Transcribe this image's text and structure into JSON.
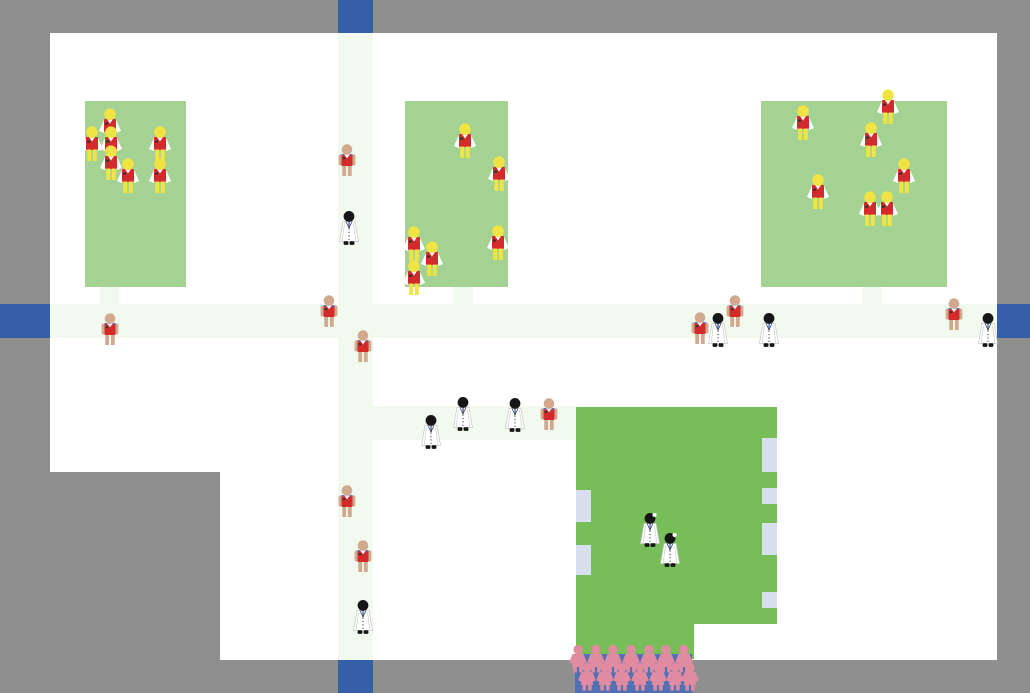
{
  "app": {
    "title": "village-simulation-map"
  },
  "colors": {
    "surround": "#8f8f8f",
    "map_ground": "#ffffff",
    "road": "#f2faf0",
    "field_green": "#a3d292",
    "building_green": "#77be59",
    "window_lavender": "#d8dfee",
    "exit_blue": "#3560a8",
    "farmer_skin": "#f0e344",
    "villager_skin": "#d0a98e",
    "vest_red": "#d32b2b",
    "sleeve_white": "#ffffff",
    "doctor_black": "#161616",
    "coat_white": "#ffffff",
    "coat_outline": "#c6c6c6",
    "tie_blue": "#4a79d6",
    "badge_dark": "#333333",
    "crowd_pink": "#e18ba0",
    "crowd_blue": "#5271b5"
  },
  "map": {
    "areas": [
      {
        "name": "map-area-main",
        "x": 220,
        "y": 33,
        "w": 777,
        "h": 627
      },
      {
        "name": "map-area-left",
        "x": 50,
        "y": 33,
        "w": 170,
        "h": 439
      }
    ],
    "roads": [
      {
        "name": "road-vertical",
        "x": 338,
        "y": 33,
        "w": 35,
        "h": 627
      },
      {
        "name": "road-horizontal",
        "x": 50,
        "y": 304,
        "w": 947,
        "h": 34
      },
      {
        "name": "road-building-path",
        "x": 373,
        "y": 406,
        "w": 203,
        "h": 34
      },
      {
        "name": "road-stub-field-1",
        "x": 100,
        "y": 287,
        "w": 19,
        "h": 17
      },
      {
        "name": "road-stub-field-2",
        "x": 453,
        "y": 287,
        "w": 20,
        "h": 17
      },
      {
        "name": "road-stub-field-3",
        "x": 862,
        "y": 287,
        "w": 20,
        "h": 17
      }
    ],
    "exits": [
      {
        "name": "map-exit-top",
        "x": 338,
        "y": 0,
        "w": 35,
        "h": 33
      },
      {
        "name": "map-exit-left",
        "x": 0,
        "y": 304,
        "w": 50,
        "h": 34
      },
      {
        "name": "map-exit-right",
        "x": 997,
        "y": 304,
        "w": 33,
        "h": 34
      },
      {
        "name": "map-exit-bottom",
        "x": 338,
        "y": 660,
        "w": 35,
        "h": 33
      }
    ],
    "fields": [
      {
        "name": "field-1",
        "x": 85,
        "y": 101,
        "w": 101,
        "h": 186
      },
      {
        "name": "field-2",
        "x": 405,
        "y": 101,
        "w": 103,
        "h": 186
      },
      {
        "name": "field-3",
        "x": 761,
        "y": 101,
        "w": 186,
        "h": 186
      }
    ],
    "building": {
      "name": "clinic-building",
      "parts": [
        {
          "x": 576,
          "y": 407,
          "w": 201,
          "h": 217
        },
        {
          "x": 576,
          "y": 624,
          "w": 118,
          "h": 35
        }
      ],
      "windows": [
        {
          "x": 576,
          "y": 490,
          "w": 15,
          "h": 32
        },
        {
          "x": 576,
          "y": 545,
          "w": 15,
          "h": 30
        },
        {
          "x": 762,
          "y": 438,
          "w": 15,
          "h": 34
        },
        {
          "x": 762,
          "y": 488,
          "w": 15,
          "h": 16
        },
        {
          "x": 762,
          "y": 523,
          "w": 15,
          "h": 32
        },
        {
          "x": 762,
          "y": 592,
          "w": 15,
          "h": 16
        }
      ]
    },
    "crowd": {
      "name": "visitor-queue",
      "bg": {
        "x": 575,
        "y": 654,
        "w": 117,
        "h": 39
      },
      "figure_w": 22,
      "figure_h": 30,
      "rows": [
        {
          "y": 645,
          "xs": [
            578,
            596,
            613,
            631,
            649,
            666,
            684
          ]
        },
        {
          "y": 663,
          "xs": [
            587,
            605,
            622,
            640,
            658,
            675,
            690
          ]
        }
      ]
    },
    "characters": [
      {
        "type": "farmer",
        "x": 110,
        "y": 108
      },
      {
        "type": "farmer",
        "x": 92,
        "y": 126
      },
      {
        "type": "farmer",
        "x": 111,
        "y": 126
      },
      {
        "type": "farmer",
        "x": 160,
        "y": 126
      },
      {
        "type": "farmer",
        "x": 111,
        "y": 145
      },
      {
        "type": "farmer",
        "x": 128,
        "y": 158
      },
      {
        "type": "farmer",
        "x": 160,
        "y": 158
      },
      {
        "type": "farmer",
        "x": 465,
        "y": 123
      },
      {
        "type": "farmer",
        "x": 499,
        "y": 156
      },
      {
        "type": "farmer",
        "x": 498,
        "y": 225
      },
      {
        "type": "farmer",
        "x": 414,
        "y": 226
      },
      {
        "type": "farmer",
        "x": 432,
        "y": 241
      },
      {
        "type": "farmer",
        "x": 414,
        "y": 260
      },
      {
        "type": "farmer",
        "x": 803,
        "y": 105
      },
      {
        "type": "farmer",
        "x": 888,
        "y": 89
      },
      {
        "type": "farmer",
        "x": 871,
        "y": 122
      },
      {
        "type": "farmer",
        "x": 904,
        "y": 158
      },
      {
        "type": "farmer",
        "x": 818,
        "y": 174
      },
      {
        "type": "farmer",
        "x": 870,
        "y": 191
      },
      {
        "type": "farmer",
        "x": 887,
        "y": 191
      },
      {
        "type": "villager",
        "x": 347,
        "y": 144
      },
      {
        "type": "villager",
        "x": 110,
        "y": 313
      },
      {
        "type": "villager",
        "x": 329,
        "y": 295
      },
      {
        "type": "villager",
        "x": 363,
        "y": 330
      },
      {
        "type": "villager",
        "x": 347,
        "y": 485
      },
      {
        "type": "villager",
        "x": 363,
        "y": 540
      },
      {
        "type": "villager",
        "x": 549,
        "y": 398
      },
      {
        "type": "villager",
        "x": 700,
        "y": 312
      },
      {
        "type": "villager",
        "x": 735,
        "y": 295
      },
      {
        "type": "villager",
        "x": 954,
        "y": 298
      },
      {
        "type": "doctor",
        "x": 349,
        "y": 211
      },
      {
        "type": "doctor",
        "x": 431,
        "y": 415
      },
      {
        "type": "doctor",
        "x": 463,
        "y": 397
      },
      {
        "type": "doctor",
        "x": 515,
        "y": 398
      },
      {
        "type": "doctor",
        "x": 718,
        "y": 313
      },
      {
        "type": "doctor",
        "x": 769,
        "y": 313
      },
      {
        "type": "doctor",
        "x": 988,
        "y": 313
      },
      {
        "type": "doctor",
        "x": 363,
        "y": 600
      },
      {
        "type": "doctor_mirror",
        "x": 650,
        "y": 513
      },
      {
        "type": "doctor_mirror",
        "x": 670,
        "y": 533
      }
    ]
  }
}
